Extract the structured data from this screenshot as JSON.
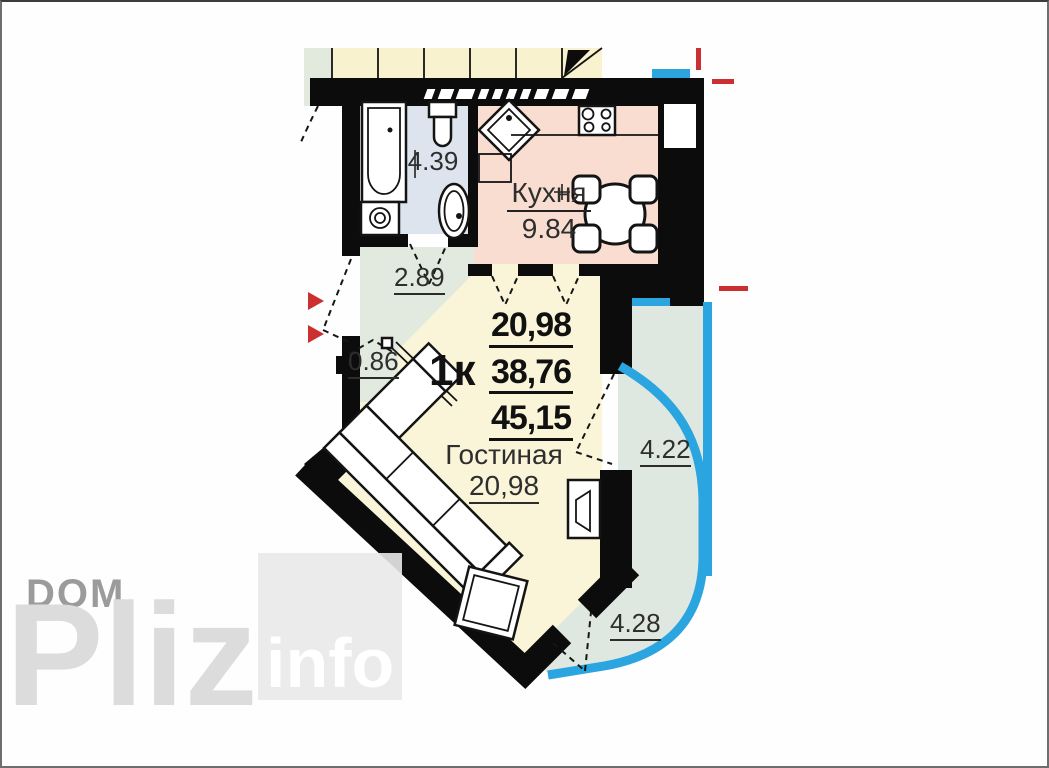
{
  "plan": {
    "rooms": {
      "bathroom": {
        "area": "4.39"
      },
      "kitchen": {
        "name": "Кухня",
        "area": "9.84"
      },
      "hall": {
        "area": "2.89"
      },
      "closet": {
        "area": "0.86"
      },
      "living": {
        "name": "Гостиная",
        "area": "20,98"
      },
      "balcony_right": {
        "area": "4.22"
      },
      "balcony_bottom": {
        "area": "4.28"
      }
    },
    "summary": {
      "type_label": "1к",
      "living_area": "20,98",
      "apartment_area": "38,76",
      "total_area": "45,15"
    }
  },
  "watermark": {
    "line1": "DOM",
    "line2": "Pliz",
    "badge": "info"
  },
  "colors": {
    "wall": "#0c0c0c",
    "kitchen_floor": "#f8ddd0",
    "bathroom_floor": "#dde4ee",
    "hall_floor": "#e2e9df",
    "living_floor": "#faf5d8",
    "balcony_floor": "#dfe8e0",
    "neighbor_floor": "#f8f2cf",
    "neighbor_green": "#e2eade",
    "glazing_blue": "#2aa5e0",
    "marker_red": "#cc2f2f",
    "label_dark": "#2e2e2e",
    "watermark_gray": "#9b9b9b",
    "watermark_light": "#dcdcdc",
    "badge_bg": "#e9e9e9",
    "badge_text": "#ffffff"
  }
}
